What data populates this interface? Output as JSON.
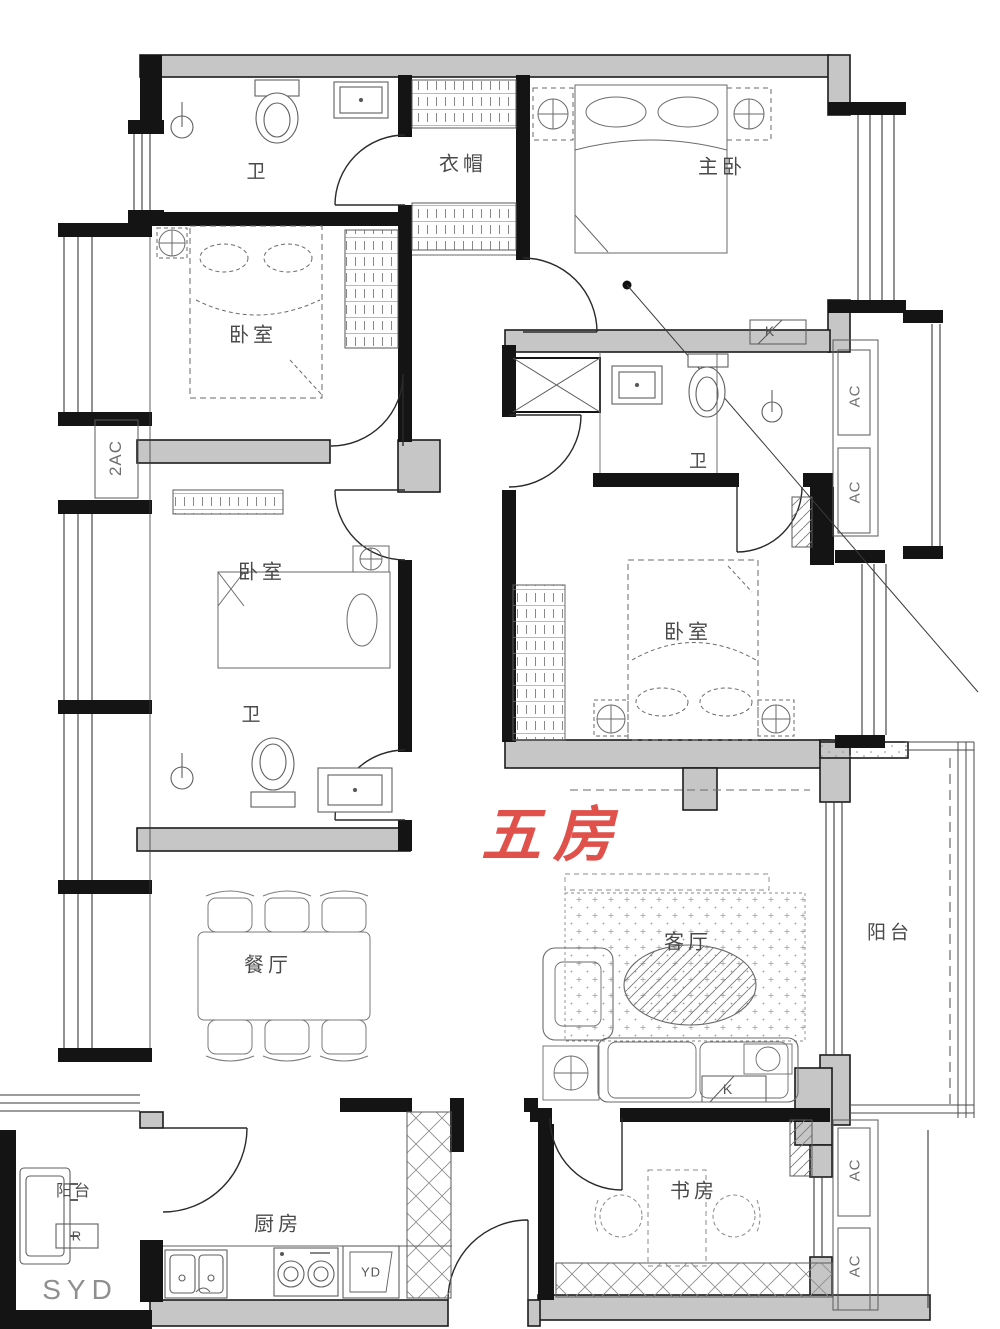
{
  "plan": {
    "title": "五房户型平面图",
    "annotation": {
      "plan_type": "五房",
      "highlight_color": "#e0514c"
    },
    "colors": {
      "wall_fill": "#c6c6c6",
      "line": "#1c1c1c",
      "furniture_line": "#6a6a6a"
    }
  },
  "rooms": {
    "bath_top": "卫",
    "cloakroom": "衣帽",
    "master_bedroom": "主卧",
    "bedroom_left_upper": "卧室",
    "bedroom_left_lower": "卧室",
    "bath_left": "卫",
    "bath_right": "卫",
    "bedroom_right": "卧室",
    "dining_room": "餐厅",
    "living_room": "客厅",
    "balcony_right": "阳台",
    "balcony_left": "阳台",
    "kitchen": "厨房",
    "study": "书房"
  },
  "equipment": {
    "ac_double": "2AC",
    "ac_right_top": "AC",
    "ac_right_mid": "AC",
    "ac_bottom_upper": "AC",
    "ac_bottom_lower": "AC",
    "k_master": "K",
    "k_living": "K",
    "refrigerator": "R",
    "drying_area": "SYD",
    "laundry_area": "YD"
  }
}
